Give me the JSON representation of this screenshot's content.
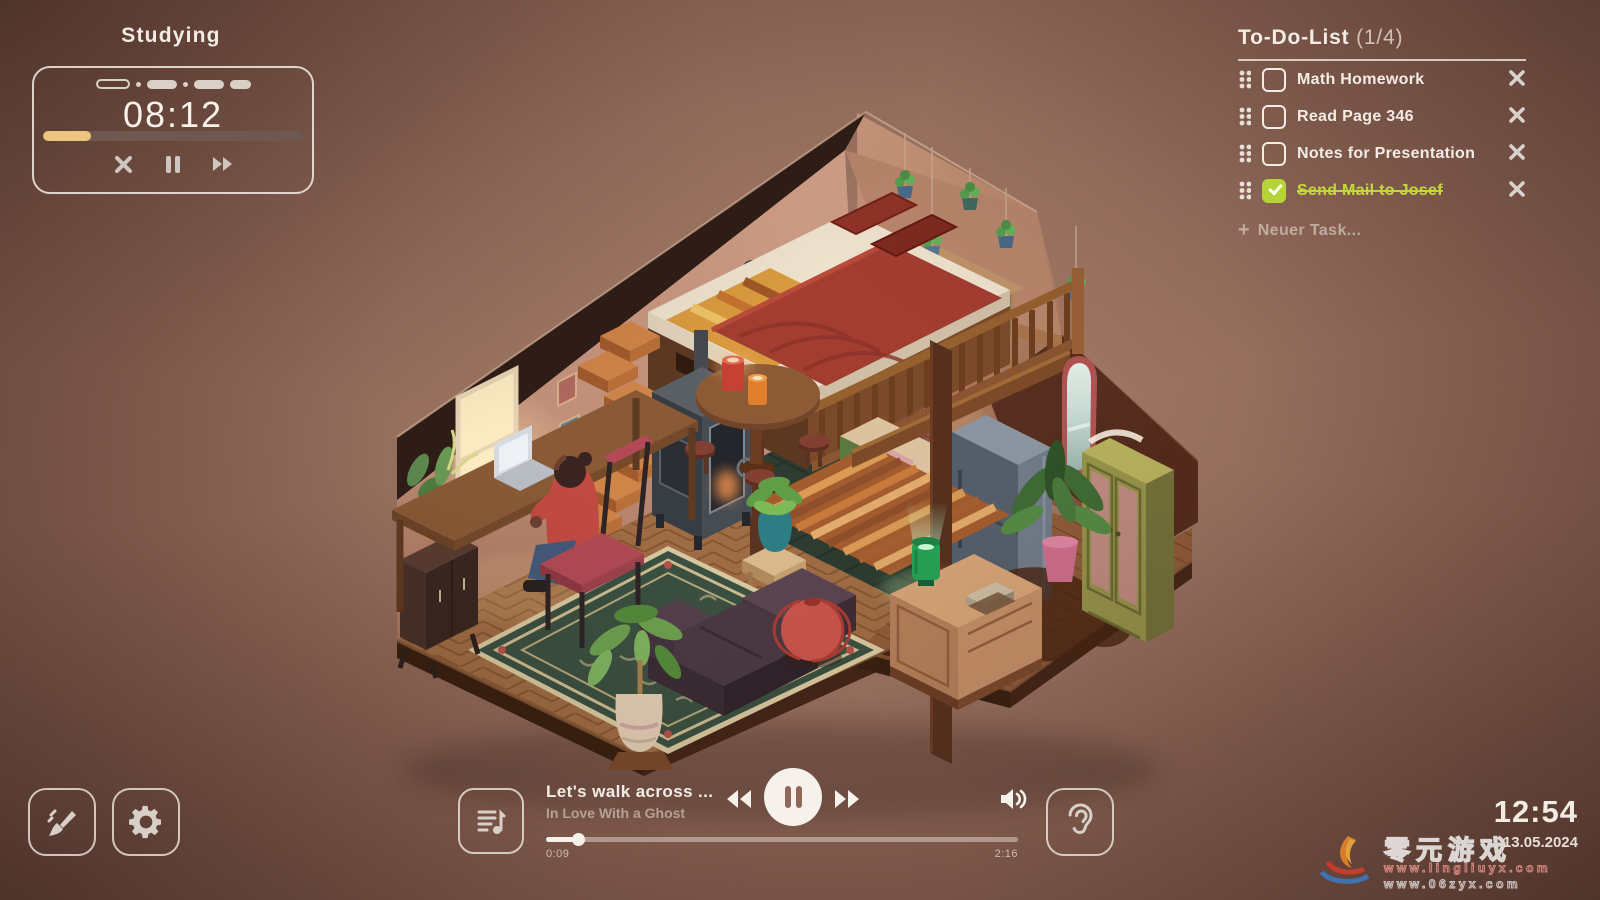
{
  "hud": {
    "session": {
      "label": "Studying",
      "time": "08:12",
      "progress_percent": 18.5
    },
    "todo": {
      "title": "To-Do-List",
      "count": "(1/4)",
      "items": [
        {
          "label": "Math Homework",
          "done": false
        },
        {
          "label": "Read Page 346",
          "done": false
        },
        {
          "label": "Notes for Presentation",
          "done": false
        },
        {
          "label": "Send Mail to Josef",
          "done": true
        }
      ],
      "add_plus": "+",
      "add_label": "Neuer Task..."
    },
    "player": {
      "track": "Let's walk across ...",
      "artist": "In Love With a Ghost",
      "elapsed": "0:09",
      "duration": "2:16",
      "progress_percent": 7
    },
    "clock": {
      "time": "12:54",
      "date": "13.05.2024"
    }
  },
  "watermark": {
    "cn_text": "零元游戏",
    "url1": "www.lingliuyx.com",
    "url2": "www.06zyx.com"
  },
  "icons": {
    "timer_controls": [
      "close-icon",
      "pause-icon",
      "fast-forward-icon"
    ],
    "todo_row": [
      "drag-handle-icon",
      "checkbox",
      "delete-cross-icon"
    ],
    "player": [
      "playlist-note-icon",
      "rewind-icon",
      "pause-icon",
      "fast-forward-icon",
      "volume-icon",
      "ear-icon"
    ],
    "corner": [
      "paintbrush-icon",
      "gear-icon"
    ]
  },
  "colors": {
    "timer_fill": "#ecc57e",
    "done_green": "#b5d435",
    "done_text": "#c3d838",
    "hud_text": "#f3ece4",
    "background_center": "#a87d6a",
    "background_edge": "#5b3d34"
  }
}
